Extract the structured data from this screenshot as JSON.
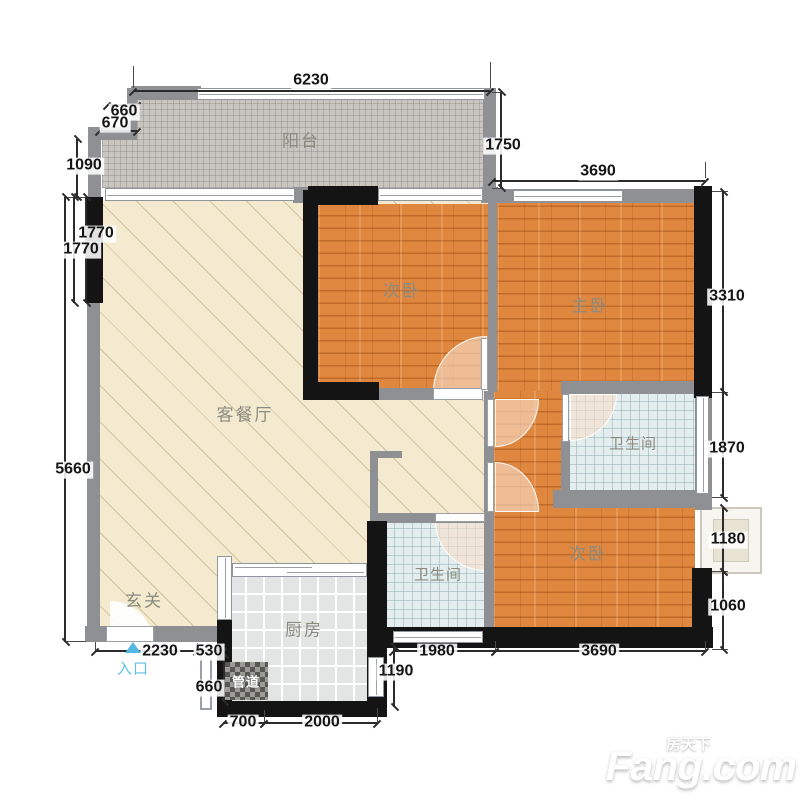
{
  "colors": {
    "wall_gray": "#8e9094",
    "wall_black": "#141414",
    "wood_floor": "#e0873f",
    "living_floor": "#f3ead0",
    "balcony_tile": "#c9c5c0",
    "bath_tile": "#e4eeee",
    "kitchen_tile": "#e2e5e3",
    "door_arc": "#f7dec9",
    "entrance_blue": "#5fc0e6",
    "dimension_text": "#151515",
    "room_label": "#8b8b7f"
  },
  "rooms": {
    "balcony": "阳台",
    "bedroom_top": "次卧",
    "master_bedroom": "主卧",
    "living_dining": "客餐厅",
    "bathroom_right": "卫生间",
    "bathroom_mid": "卫生间",
    "bedroom_bottom": "次卧",
    "kitchen": "厨房",
    "foyer": "玄关",
    "pipe_duct": "管道",
    "entrance": "入口"
  },
  "dims": {
    "top_6230": "6230",
    "top_3690": "3690",
    "left_660": "660",
    "left_670": "670",
    "left_1090": "1090",
    "left_1770a": "1770",
    "left_1770b": "1770",
    "left_5660": "5660",
    "right_1750": "1750",
    "right_3310": "3310",
    "right_1870": "1870",
    "right_1180": "1180",
    "right_1060": "1060",
    "bottom_2230": "2230",
    "bottom_530": "530",
    "bottom_660": "660",
    "bottom_700": "700",
    "bottom_2000": "2000",
    "bottom_1190": "1190",
    "bottom_1980": "1980",
    "bottom_3690": "3690"
  },
  "watermark": {
    "cn": "房天下",
    "en": "Fang.com"
  }
}
